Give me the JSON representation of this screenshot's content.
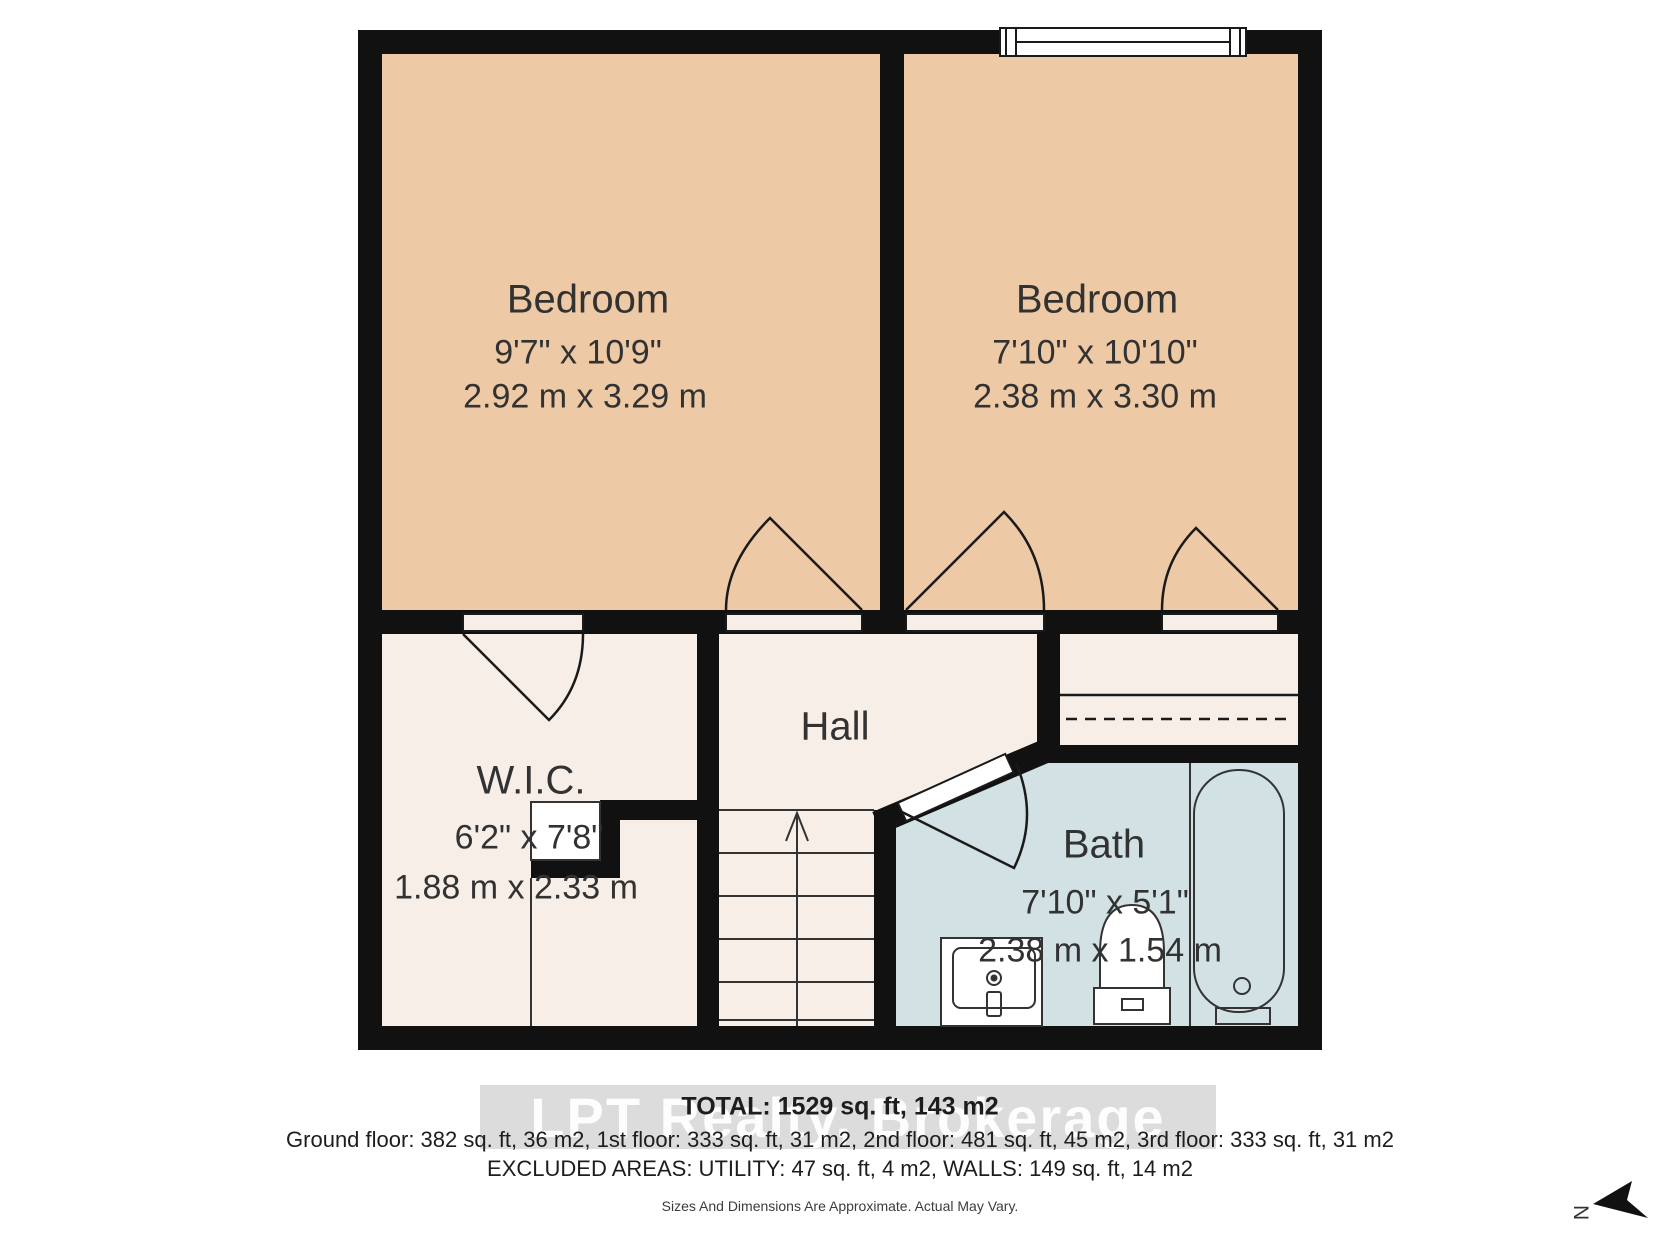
{
  "floorplan": {
    "rooms": {
      "bedroom1": {
        "name": "Bedroom",
        "imperial": "9'7\" x 10'9\"",
        "metric": "2.92 m x 3.29 m"
      },
      "bedroom2": {
        "name": "Bedroom",
        "imperial": "7'10\" x 10'10\"",
        "metric": "2.38 m x 3.30 m"
      },
      "wic": {
        "name": "W.I.C.",
        "imperial": "6'2\" x 7'8\"",
        "metric": "1.88 m x 2.33 m"
      },
      "hall": {
        "name": "Hall"
      },
      "bath": {
        "name": "Bath",
        "imperial": "7'10\" x 5'1\"",
        "metric": "2.38 m x 1.54 m"
      }
    },
    "north_label": "N"
  },
  "footer": {
    "total": "TOTAL: 1529 sq. ft, 143 m2",
    "floors": "Ground floor: 382 sq. ft, 36 m2, 1st floor: 333 sq. ft, 31 m2, 2nd floor: 481 sq. ft, 45 m2, 3rd floor: 333 sq. ft, 31 m2",
    "excluded": "EXCLUDED AREAS: UTILITY: 47 sq. ft, 4 m2, WALLS: 149 sq. ft, 14 m2",
    "disclaimer": "Sizes And Dimensions Are Approximate. Actual May Vary.",
    "watermark": "LPT Realty, Brokerage"
  },
  "colors": {
    "wall": "#111111",
    "bedroom_fill": "#edc9a5",
    "room_fill": "#f6eee7",
    "bath_fill": "#d2e1e3",
    "line": "#1a1a1a"
  }
}
